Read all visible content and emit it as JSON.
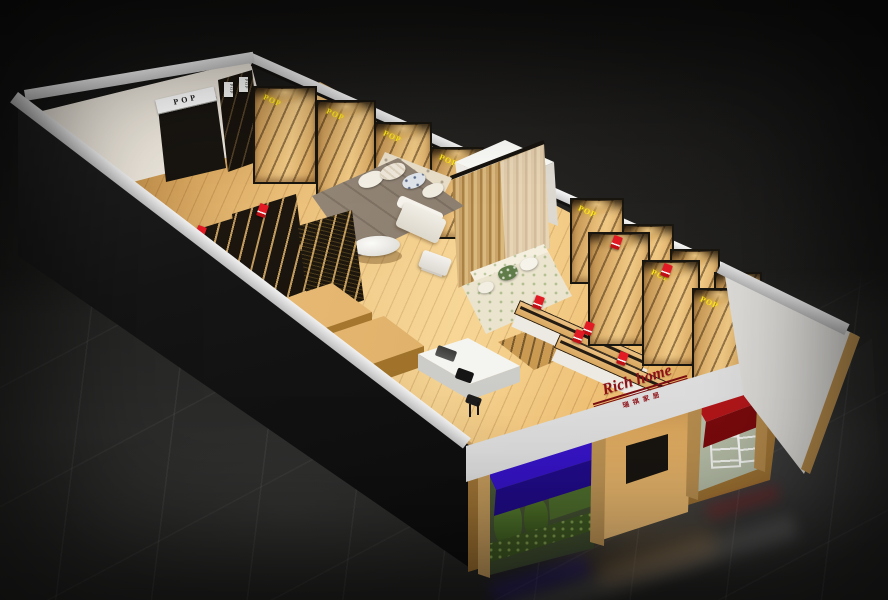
{
  "scene": {
    "description": "3D perspective cutaway render of a retail home-goods store interior on a dark glossy tiled floor",
    "view": "isometric dollhouse cutaway, dark studio background"
  },
  "storefront": {
    "sign_text": "Rich home",
    "sign_subtext": "瑞祺家居",
    "sign_color": "#8e1016",
    "fascia_color": "#e9e9e9",
    "awning_left_color": "#3813cf",
    "awning_right_color": "#b51317"
  },
  "signs": {
    "pop": "POP",
    "pop_yellow_color": "#ffe61a",
    "pop_white_bg": "#ffffff",
    "pop_white_text": "#1c1c1c"
  },
  "palette": {
    "wood_floor": "#e9b96d",
    "wood_shelf": "#d3a35f",
    "frame_black": "#17130f",
    "wall_white": "#efe9df",
    "band_silver": "#e6e6e6",
    "exterior_black": "#121212",
    "bed_cover": "#8d7f6e",
    "sofa_floral": "#efe9d4",
    "plant_green": "#4d6e2c",
    "tag_red": "#d01622",
    "background": "#141414"
  },
  "objects": [
    "wall shelving units with downlights",
    "display bed with pillows",
    "floral fabric sofa",
    "white loveseat",
    "oval coffee table",
    "curtain display panel",
    "black mesh display cabinets",
    "wood platform display tables",
    "double-sided wood gondolas with red sale tags",
    "white cashier counter with stool",
    "fitting-room box",
    "storefront windows with plant display and white racks"
  ]
}
